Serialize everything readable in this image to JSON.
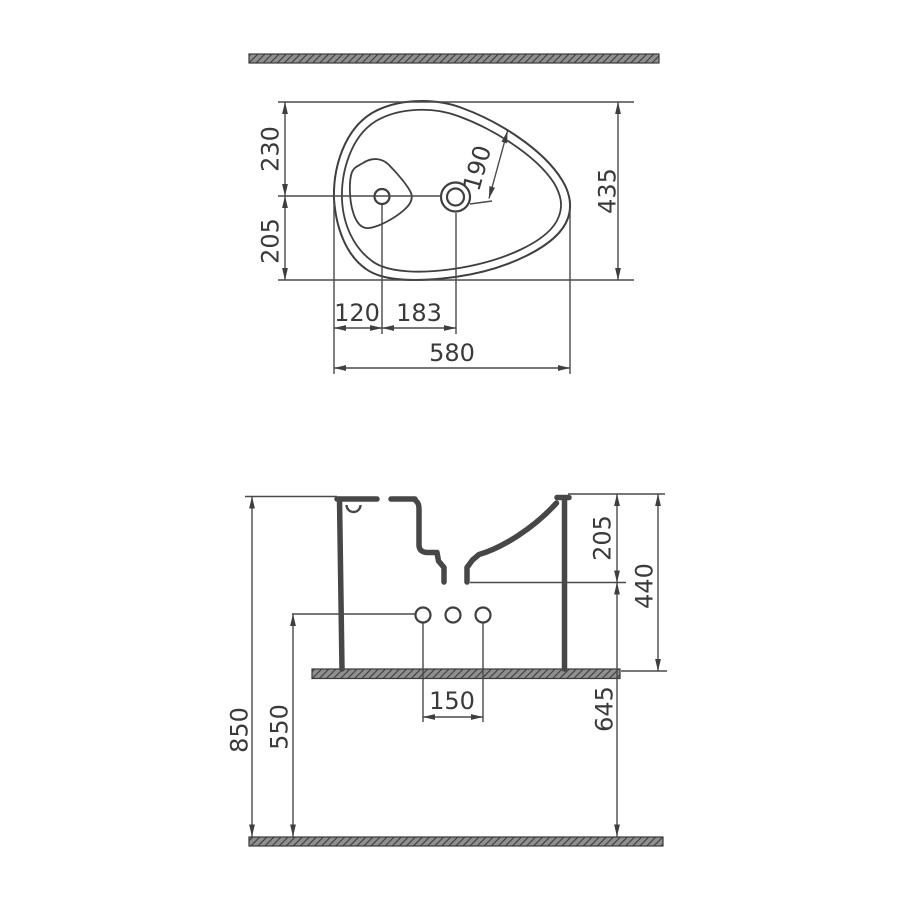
{
  "drawing": {
    "type": "technical-dimension-drawing"
  },
  "top_view": {
    "rear_to_centerline": "230",
    "centerline_to_front": "205",
    "faucet_to_rim": "190",
    "depth_overall": "435",
    "edge_to_drain": "120",
    "drain_to_faucet": "183",
    "width_overall": "580"
  },
  "side_view": {
    "rim_to_outlet": "205",
    "basin_height": "440",
    "floor_to_outlet": "645",
    "floor_to_rim": "850",
    "floor_to_holes": "550",
    "hole_spacing": "150"
  },
  "colors": {
    "background": "#ffffff",
    "line": "#4a4a4a",
    "section": "#474747",
    "text": "#3a3a3a",
    "hatch_base": "#8f8f8f",
    "hatch_stripe": "#3c3c3c"
  }
}
